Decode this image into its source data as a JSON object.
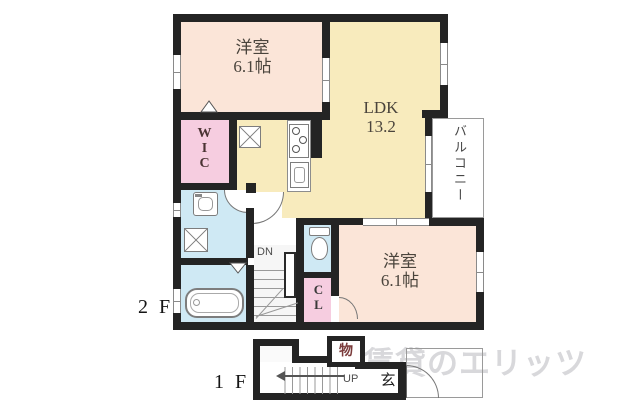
{
  "floorplan": {
    "floor2": {
      "label": "2 F",
      "bedroom1": {
        "name": "洋室",
        "size": "6.1帖"
      },
      "ldk": {
        "name": "LDK",
        "size": "13.2"
      },
      "bedroom2": {
        "name": "洋室",
        "size": "6.1帖"
      },
      "wic_label": "WIC",
      "closet_label": "CL",
      "balcony_label": "バルコニー",
      "stairs_down_label": "DN"
    },
    "floor1": {
      "label": "1 F",
      "entrance_label": "玄",
      "storage_label": "物",
      "stairs_up_label": "UP"
    },
    "watermark_text": "賃貸のエリッツ",
    "colors": {
      "wall": "#242424",
      "bedroom": "#fbe5d8",
      "ldk": "#f8ebbd",
      "closet_pink": "#f6cde0",
      "wet_blue": "#cfe9f4",
      "watermark_gray": "#d8d8db",
      "storage_char": "#7a3b3b"
    }
  }
}
